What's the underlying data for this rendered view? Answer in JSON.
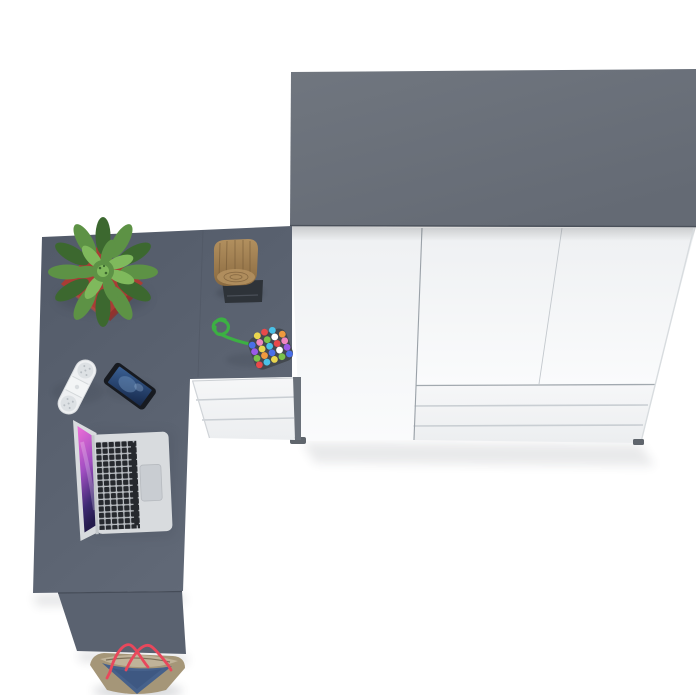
{
  "meta": {
    "type": "3d-product-render",
    "description": "Top-down view of a home office set on a white floor: a grey corner desk with a white drawer pedestal, accessories on the desktop, and a white three-door wardrobe with a grey top and lower drawers.",
    "canvas": {
      "width": 700,
      "height": 695
    }
  },
  "palette": {
    "bg": "#ffffff",
    "wardrobe-top": "#6b717c",
    "wardrobe-top-edge": "#4a505a",
    "wardrobe-side": "#3f4550",
    "front-white": "#eef0f2",
    "front-bright": "#fafbfc",
    "seam": "#9aa1a8",
    "seam-light": "#c3c8cd",
    "drawer-line": "#c9ced3",
    "foot": "#5f656c",
    "desk-dark": "#525a68",
    "desk-light": "#616977",
    "desk-panel": "#5a6270",
    "pedestal-white": "#f2f3f5",
    "pedestal-leg": "#6a717a",
    "pot-red": "#a93c35",
    "pot-red-dark": "#8c302c",
    "leaf-dark": "#3c682f",
    "leaf-mid": "#5d9245",
    "leaf-light": "#7fb95c",
    "wood": "#97764a",
    "wood-dark": "#6f5534",
    "wood-light": "#b2905f",
    "stool-base": "#2e3339",
    "cord-green": "#3cb043",
    "bead-bg": "#43484f",
    "bead0": "#e84a4a",
    "bead1": "#4a6fe8",
    "bead2": "#ead64e",
    "bead3": "#ef86c0",
    "bead4": "#ffffff",
    "bead5": "#7ac24a",
    "bead6": "#ef9a3e",
    "bead7": "#9a5ae8",
    "bead8": "#4ac2e8",
    "speaker-white": "#eef0f2",
    "speaker-grille": "#dde1e4",
    "speaker-dot": "#b8bec3",
    "phone-black": "#171a20",
    "phone-screen-light": "#7396c0",
    "laptop-silver": "#d8dbde",
    "laptop-key": "#26292e",
    "laptop-gap": "#b9bdc2",
    "trackpad": "#c9cdd2",
    "bag-denim": "#46618b",
    "bag-tan": "#a59678",
    "bag-tan-light": "#c0b399",
    "strap-red": "#e8485c",
    "shadow": "#2e3440"
  },
  "scene": {
    "objects": [
      {
        "id": "wardrobe",
        "label": "White wardrobe with grey top, three doors and bottom drawers"
      },
      {
        "id": "desk",
        "label": "Grey corner desk with white three-drawer pedestal"
      },
      {
        "id": "plant",
        "label": "Green succulent plant in red square planter"
      },
      {
        "id": "log-stool",
        "label": "Decorative wooden log on dark mat"
      },
      {
        "id": "bead-toy",
        "label": "Multicoloured bead toy with green cord"
      },
      {
        "id": "speaker",
        "label": "White capsule speaker"
      },
      {
        "id": "phone",
        "label": "Smartphone lying on the desk"
      },
      {
        "id": "laptop",
        "label": "Open laptop with purple wallpaper"
      },
      {
        "id": "bag",
        "label": "Denim and tan tote bag with red straps"
      }
    ]
  }
}
